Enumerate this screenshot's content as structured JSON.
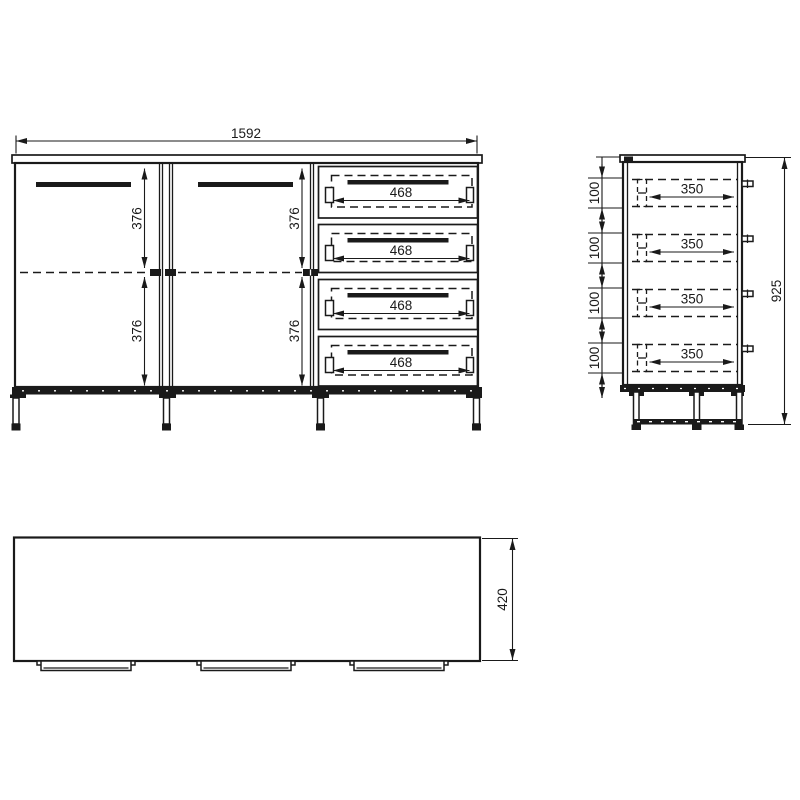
{
  "front_view": {
    "overall_width": "1592",
    "left_door": {
      "upper": "376",
      "lower": "376"
    },
    "right_door": {
      "upper": "376",
      "lower": "376"
    },
    "drawer_widths": [
      "468",
      "468",
      "468",
      "468"
    ]
  },
  "side_view": {
    "overall_height": "925",
    "drawer_vertical_spacings": [
      "100",
      "100",
      "100",
      "100"
    ],
    "drawer_depths": [
      "350",
      "350",
      "350",
      "350"
    ]
  },
  "top_view": {
    "depth": "420"
  },
  "colors": {
    "line": "#1a1a1a",
    "background": "#ffffff"
  }
}
